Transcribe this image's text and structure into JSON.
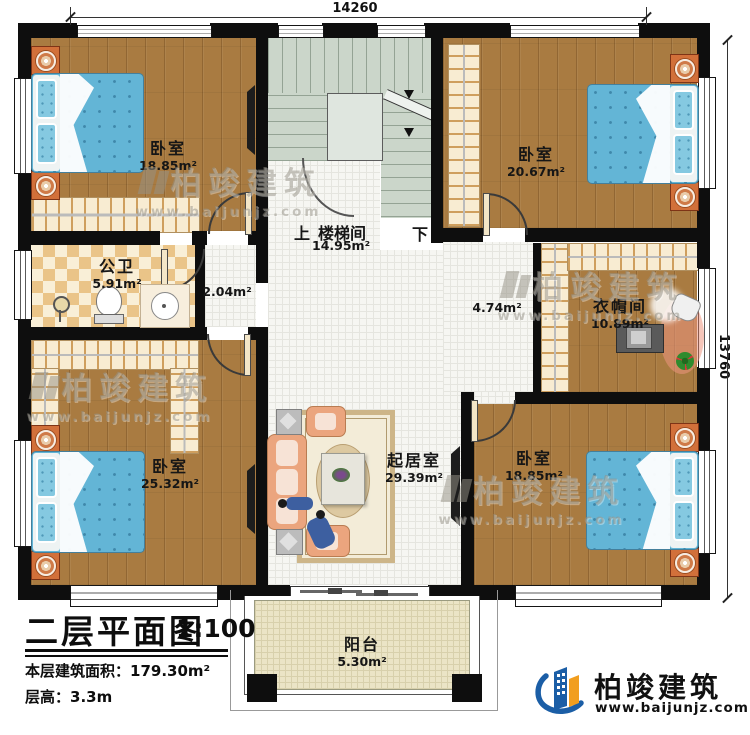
{
  "plan": {
    "dimensions": {
      "width_top": "14260",
      "height_right": "13760"
    },
    "rooms": {
      "bedroom_top_left": {
        "name": "卧室",
        "area": "18.85m²"
      },
      "bedroom_top_right": {
        "name": "卧室",
        "area": "20.67m²"
      },
      "bathroom": {
        "name": "公卫",
        "area": "5.91m²"
      },
      "corridor": {
        "area": "2.04m²"
      },
      "stairwell": {
        "up_label": "上",
        "name": "楼梯间",
        "area": "14.95m²",
        "down_label": "下"
      },
      "hallway": {
        "area": "4.74m²"
      },
      "cloakroom": {
        "name": "衣帽间",
        "area": "10.89m²"
      },
      "bedroom_bottom_left": {
        "name": "卧室",
        "area": "25.32m²"
      },
      "living_room": {
        "name": "起居室",
        "area": "29.39m²"
      },
      "bedroom_bottom_right": {
        "name": "卧室",
        "area": "18.85m²"
      },
      "balcony": {
        "name": "阳台",
        "area": "5.30m²"
      }
    }
  },
  "title_block": {
    "title": "二层平面图",
    "scale": "1:100",
    "floor_area_label": "本层建筑面积：",
    "floor_area_value": "179.30m²",
    "floor_height_label": "层高：",
    "floor_height_value": "3.3m"
  },
  "branding": {
    "company": "柏竣建筑",
    "website": "www.baijunjz.com"
  },
  "watermark": {
    "company": "柏竣建筑",
    "website": "www.baijunjz.com"
  },
  "colors": {
    "wall": "#0e0e0e",
    "wood_floor": "#a97b41",
    "tile_floor": "#f6f6f2",
    "bathroom_tile": "#eac488",
    "stair": "#cbd6ca",
    "bed": "#63b5d6",
    "nightstand": "#d2703a",
    "sofa": "#eba57e",
    "balcony_floor": "#ebe4c6",
    "logo_blue": "#1b5ea6",
    "logo_orange": "#f19e1f"
  }
}
